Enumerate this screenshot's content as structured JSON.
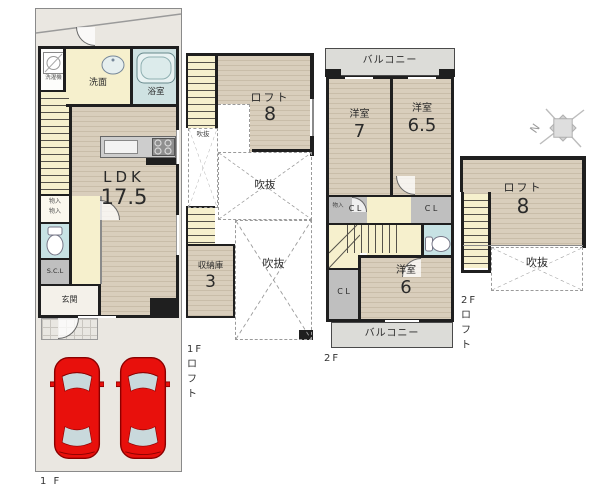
{
  "f1": {
    "plan_label": "1 F",
    "washroom": "洗面",
    "bath": "浴室",
    "washer": "洗濯機",
    "ldk": "LDK",
    "ldk_size": "17.5",
    "closet": "物入",
    "scl": "S.C.L",
    "entrance": "玄関"
  },
  "f1loft": {
    "plan_label": "1Fロフト",
    "loft": "ロフト",
    "loft_size": "8",
    "void": "吹抜",
    "storage": "収納庫",
    "storage_size": "3"
  },
  "f2": {
    "plan_label": "2F",
    "balcony": "バルコニー",
    "room": "洋室",
    "room7_size": "7",
    "room65_size": "6.5",
    "room6_size": "6",
    "cl": "C L",
    "closet": "物入"
  },
  "f2loft": {
    "plan_label": "2Fロフト",
    "loft": "ロフト",
    "loft_size": "8",
    "void": "吹抜",
    "compass_n": "N"
  },
  "colors": {
    "wall": "#1f1f1f",
    "wood_floor": "#d9cebc",
    "stairs_hall": "#f6f0cd",
    "bathroom_blue": "#cfe2e2",
    "toilet_blue": "#c7e2e4",
    "closet_gray": "#bfbfbf",
    "balcony_gray": "#dcdcd8",
    "site_gray": "#eae7e1",
    "car_red": "#e8100c",
    "car_glass": "#c9d9dc"
  }
}
